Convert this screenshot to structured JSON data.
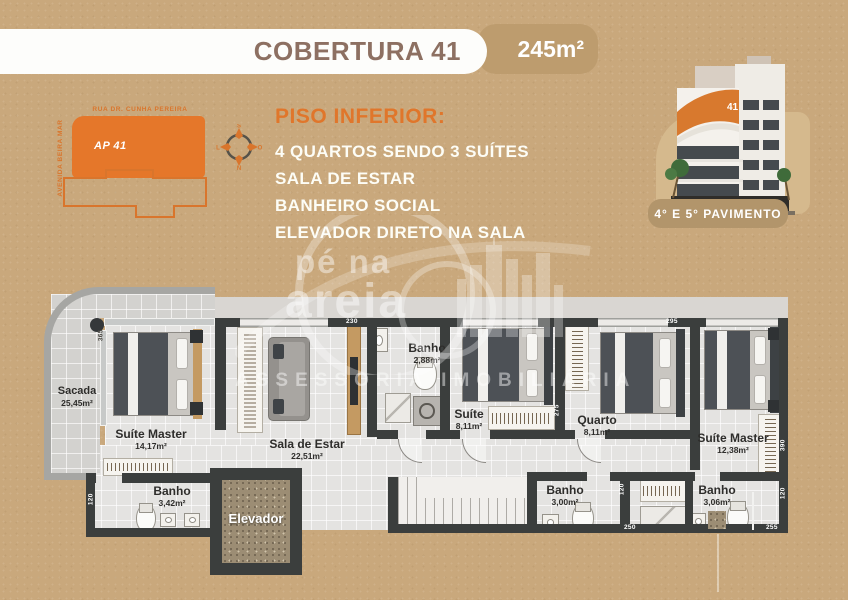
{
  "header": {
    "title": "COBERTURA 41",
    "area_badge": "245m²"
  },
  "map": {
    "street_top": "RUA DR. CUNHA PEREIRA",
    "street_left": "AVENIDA BEIRA MAR",
    "unit_label": "AP 41",
    "compass": {
      "top": "S",
      "right": "O",
      "bottom": "N",
      "left": "L"
    }
  },
  "info": {
    "heading": "PISO INFERIOR:",
    "items": [
      "4 QUARTOS SENDO 3 SUÍTES",
      "SALA DE ESTAR",
      "BANHEIRO SOCIAL",
      "ELEVADOR DIRETO NA SALA"
    ]
  },
  "building": {
    "number": "41",
    "badge": "4° E 5° PAVIMENTO"
  },
  "watermark": {
    "logo_line1": "pé na",
    "logo_line2": "areia",
    "tagline": "ASSESSORIA IMOBILIÁRIA"
  },
  "plan": {
    "rooms": [
      {
        "name": "Sacada",
        "area": "25,45m²"
      },
      {
        "name": "Suíte Master",
        "area": "14,17m²"
      },
      {
        "name": "Sala de Estar",
        "area": "22,51m²"
      },
      {
        "name": "Banho",
        "area": "2,88m²"
      },
      {
        "name": "Suíte",
        "area": "8,11m²"
      },
      {
        "name": "Quarto",
        "area": "8,11m²"
      },
      {
        "name": "Suíte Master",
        "area": "12,38m²"
      },
      {
        "name": "Banho",
        "area": "3,42m²"
      },
      {
        "name": "Banho",
        "area": "3,00m²"
      },
      {
        "name": "Banho",
        "area": "3,06m²"
      },
      {
        "name": "Elevador",
        "area": ""
      }
    ],
    "dimensions": [
      "230",
      "295",
      "365",
      "275",
      "120",
      "250",
      "255",
      "120",
      "390",
      "120"
    ]
  },
  "colors": {
    "accent": "#e0762b",
    "background": "#c9a87c",
    "wall": "#3b3e3d",
    "badge_tan": "#bd9c6e"
  }
}
